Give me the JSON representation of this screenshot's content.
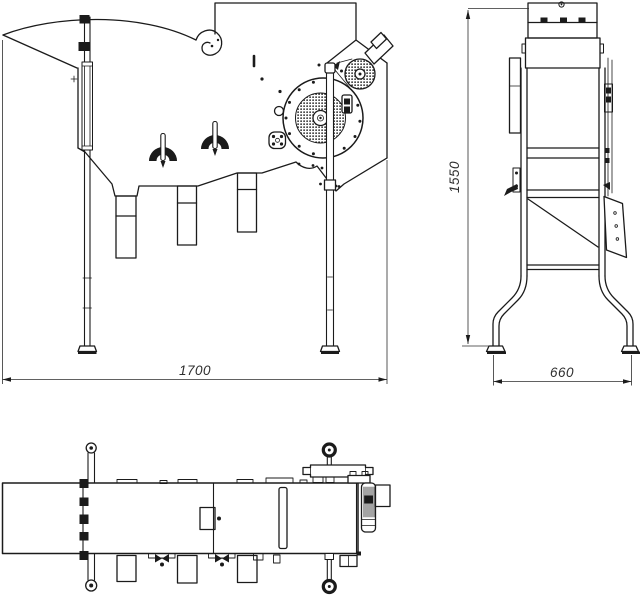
{
  "colors": {
    "background": "#ffffff",
    "ink": "#1b1b1b",
    "dimension": "#2e2e2e"
  },
  "dimensions": {
    "overall_length": "1700",
    "overall_height": "1550",
    "overall_depth": "660"
  }
}
